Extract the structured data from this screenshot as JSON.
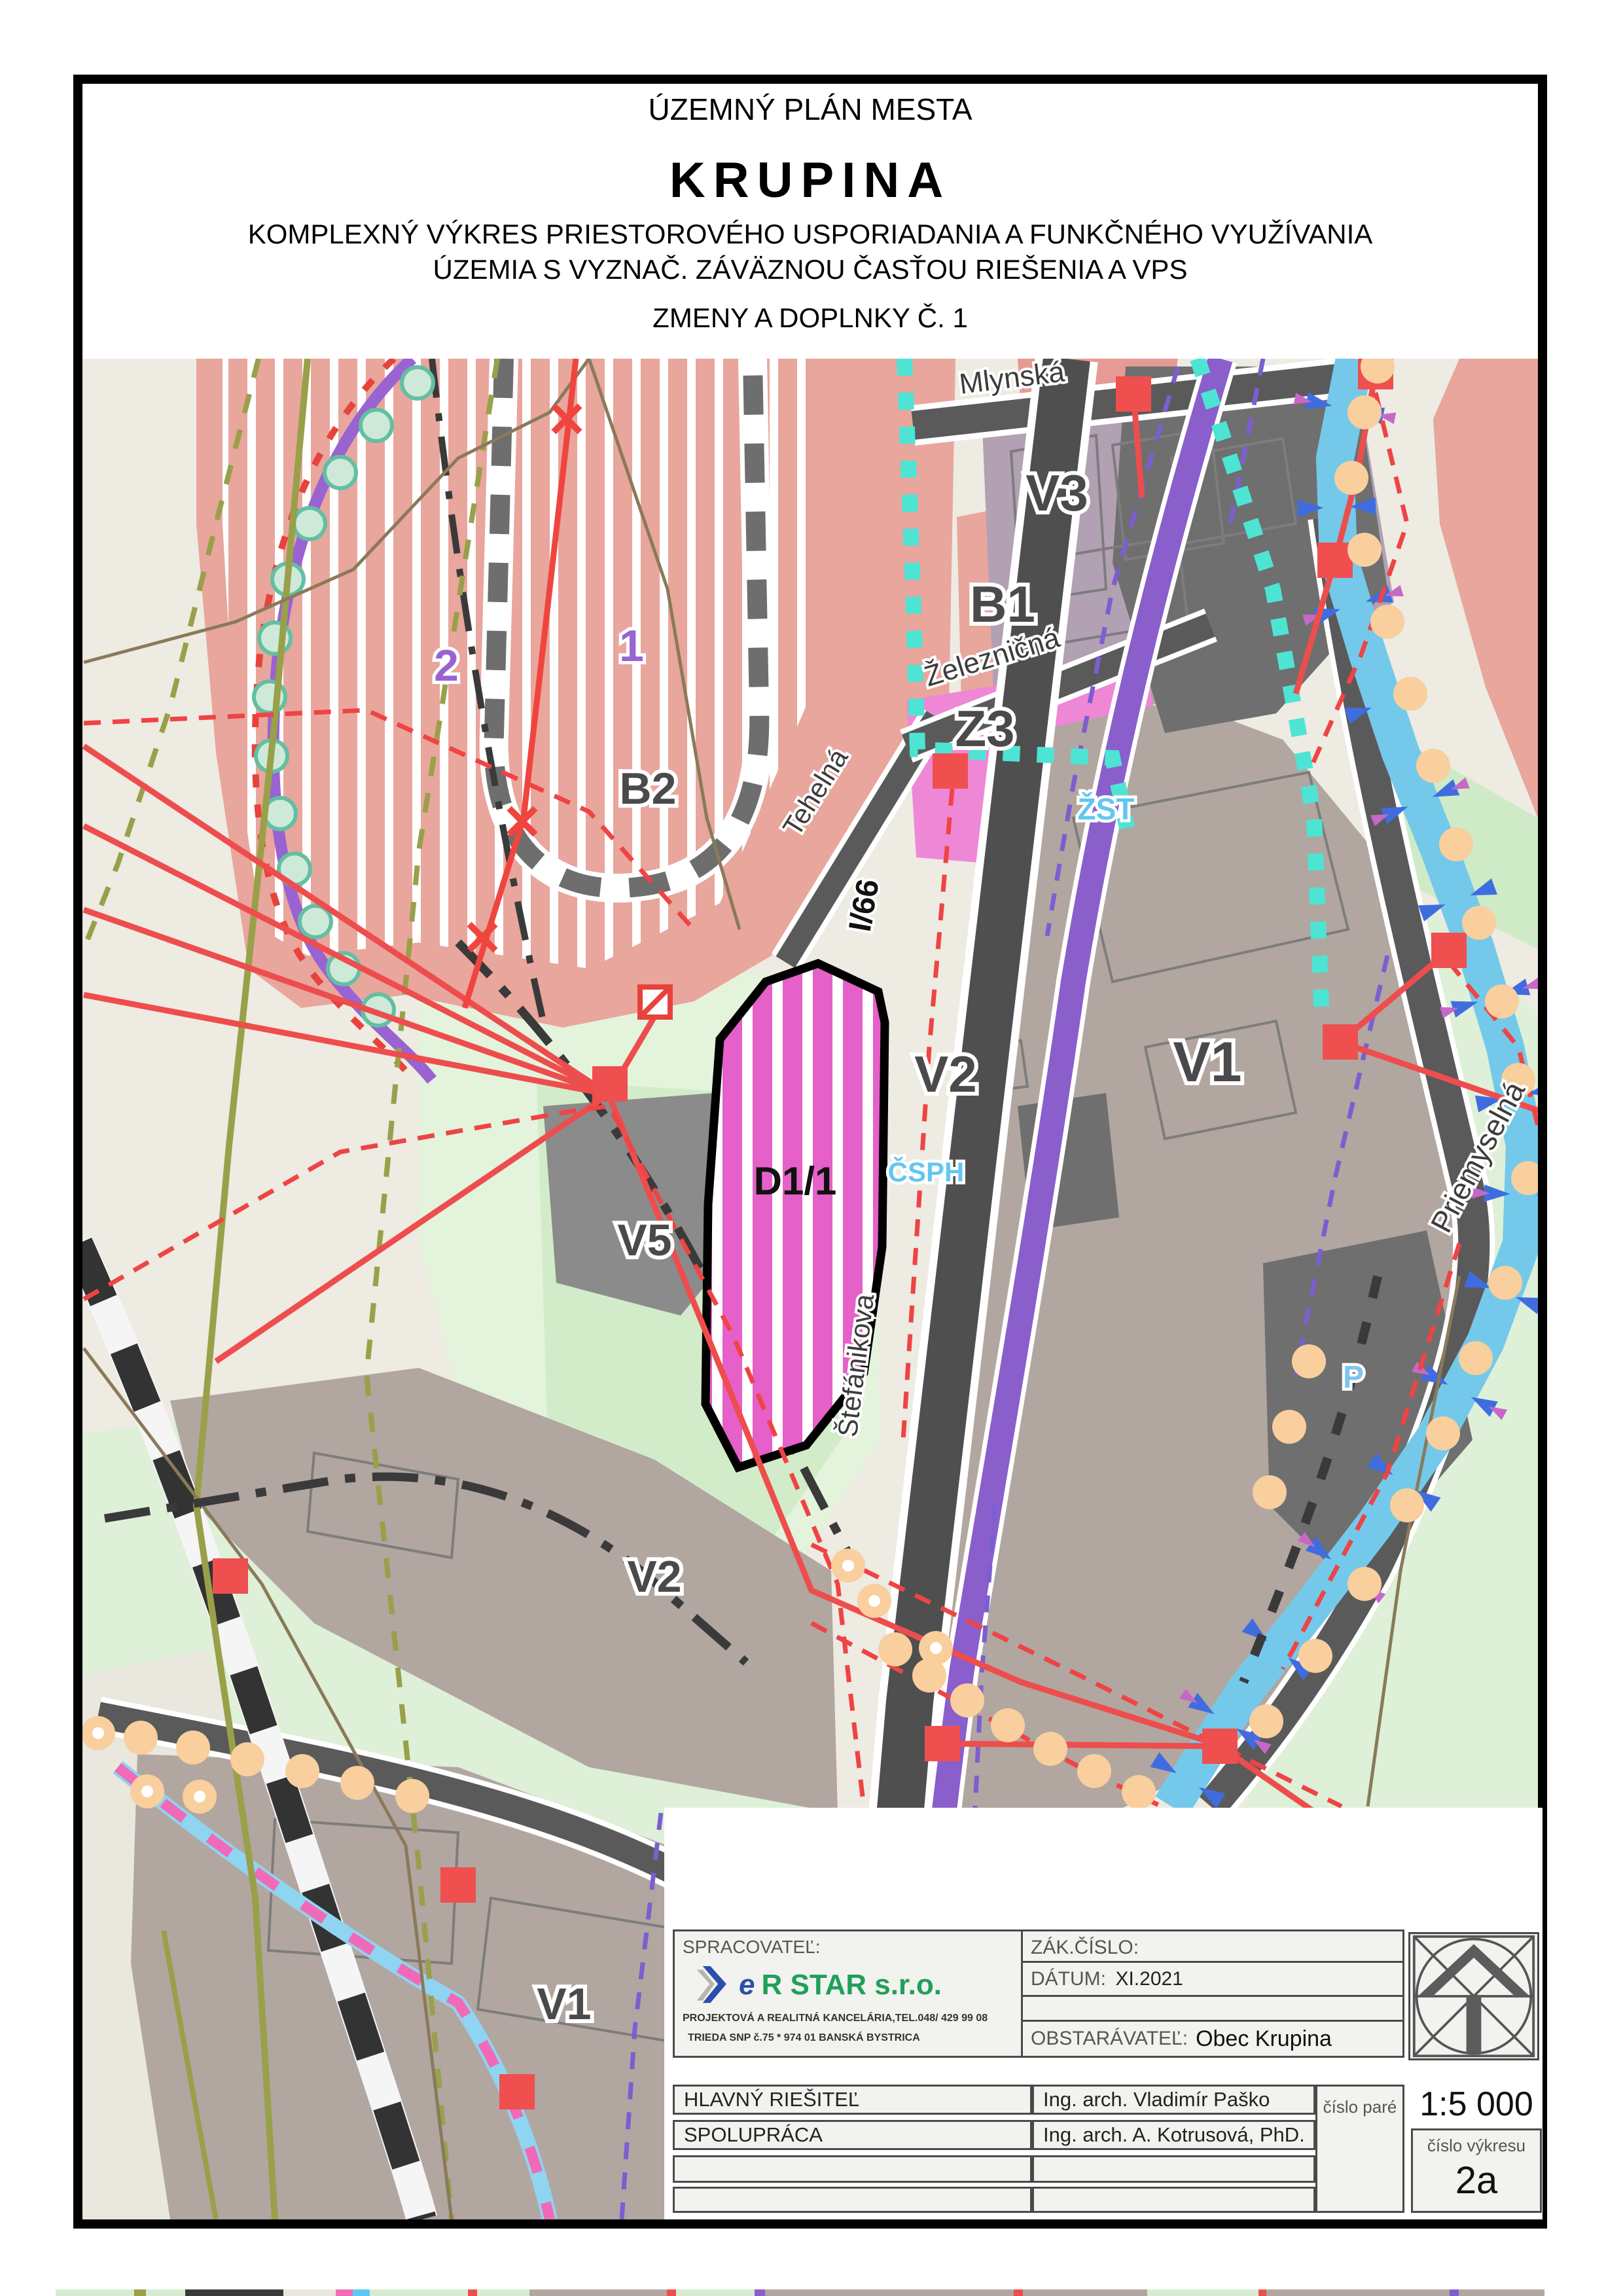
{
  "page_title": {
    "line1": "ÚZEMNÝ PLÁN MESTA",
    "line2": "KRUPINA",
    "line3": "KOMPLEXNÝ VÝKRES PRIESTOROVÉHO USPORIADANIA A FUNKČNÉHO VYUŽÍVANIA",
    "line4": "ÚZEMIA S VYZNAČ. ZÁVÄZNOU ČASŤOU RIEŠENIA A VPS",
    "line5": "ZMENY A DOPLNKY Č. 1"
  },
  "map": {
    "zones": [
      {
        "label": "V3"
      },
      {
        "label": "B1"
      },
      {
        "label": "Z3"
      },
      {
        "label": "B2"
      },
      {
        "label": "V2"
      },
      {
        "label": "V1"
      },
      {
        "label": "V5"
      },
      {
        "label": "V2"
      },
      {
        "label": "V1"
      },
      {
        "label": "D1/1"
      }
    ],
    "change_marks": [
      {
        "label": "1"
      },
      {
        "label": "2"
      }
    ],
    "poi": [
      {
        "label": "ŽST"
      },
      {
        "label": "ČSPH"
      },
      {
        "label": "P"
      }
    ],
    "streets": [
      {
        "name": "Mlynská"
      },
      {
        "name": "Železničná"
      },
      {
        "name": "Tehelná"
      },
      {
        "name": "I/66"
      },
      {
        "name": "Štefánikova"
      },
      {
        "name": "Priemyselná"
      }
    ]
  },
  "title_block": {
    "spracovatel_label": "SPRACOVATEĽ:",
    "logo_e": "e",
    "logo_name": "R STAR s.r.o.",
    "logo_sub1": "PROJEKTOVÁ A REALITNÁ KANCELÁRIA,TEL.048/ 429 99 08",
    "logo_sub2": "TRIEDA SNP  č.75 * 974 01 BANSKÁ BYSTRICA",
    "zak_cislo_label": "ZÁK.ČÍSLO:",
    "datum_label": "DÁTUM:",
    "datum_value": "XI.2021",
    "obstaravatel_label": "OBSTARÁVATEĽ:",
    "obstaravatel_value": "Obec Krupina",
    "rows": [
      {
        "label": "HLAVNÝ RIEŠITEĽ",
        "value": "Ing. arch. Vladimír Paško"
      },
      {
        "label": "SPOLUPRÁCA",
        "value": "Ing. arch. A. Kotrusová, PhD."
      },
      {
        "label": "",
        "value": ""
      },
      {
        "label": "",
        "value": ""
      }
    ],
    "cislo_pare_label": "číslo paré",
    "scale": "1:5 000",
    "cislo_vykresu_label": "číslo výkresu",
    "drawing_number": "2a"
  },
  "colors": {
    "zone_residential_salmon": "#e8a69d",
    "zone_mixed_purplegray": "#b2a0b3",
    "zone_industrial_taupe": "#b2a6a0",
    "zone_greenery_pink": "#ef87d7",
    "zone_change_magenta": "#e560c8",
    "green_area": "#def0d8",
    "water_blue": "#74c9ea",
    "road_gray": "#4f4f4f",
    "railway_corridor_purple": "#8a5ecb",
    "boundary_purple": "#9a63d2",
    "utility_red": "#ee4d4d",
    "beads_cyan": "#4de4d4",
    "poi_label_cyan": "#62c7f0",
    "tree_orange": "#f8cf9d",
    "logo_blue": "#2a4fae",
    "logo_green": "#1fa05a"
  }
}
